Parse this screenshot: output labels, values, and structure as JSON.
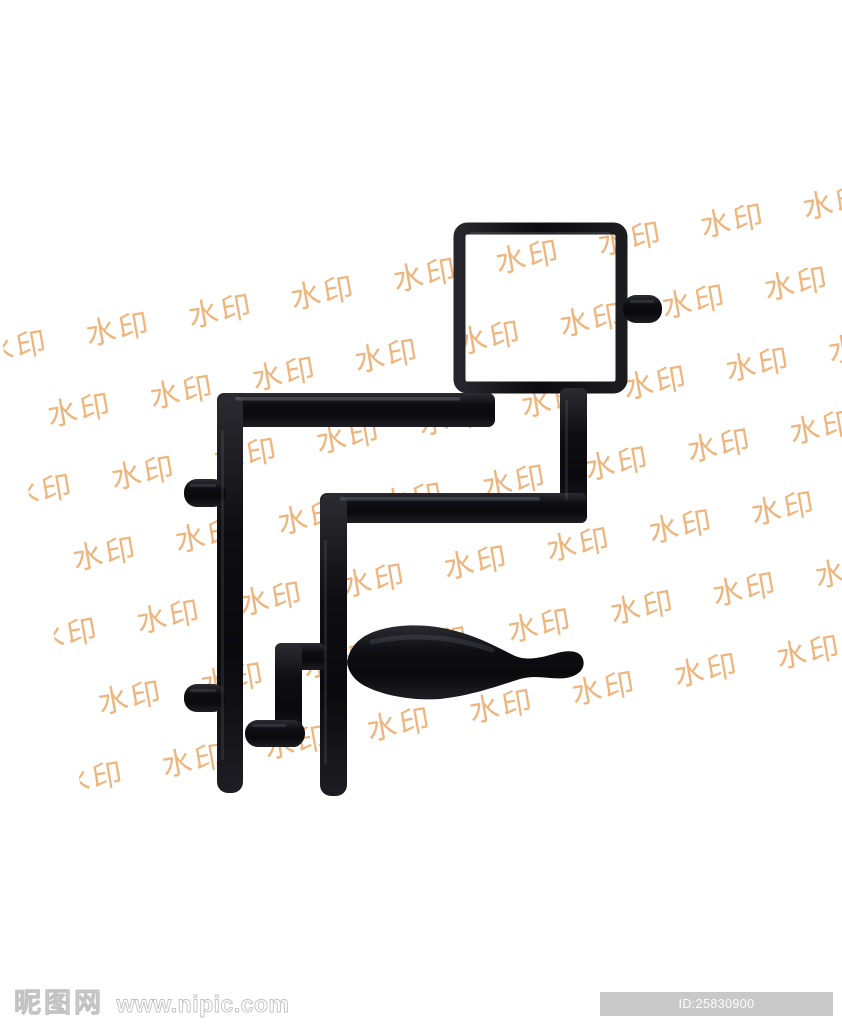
{
  "page": {
    "background": "#ffffff"
  },
  "watermark": {
    "text": "水印",
    "color": "#ecab6c"
  },
  "artwork": {
    "plastic_color": "#121216",
    "highlight_color": "#8e8e9a"
  },
  "footer": {
    "site_name": "昵图网",
    "site_url": "www.nipic.com",
    "id_text": "ID:25830900 NO:20221122101944414106",
    "badge_bg": "#c9c9c9",
    "badge_text_color": "#fdfdfd"
  }
}
